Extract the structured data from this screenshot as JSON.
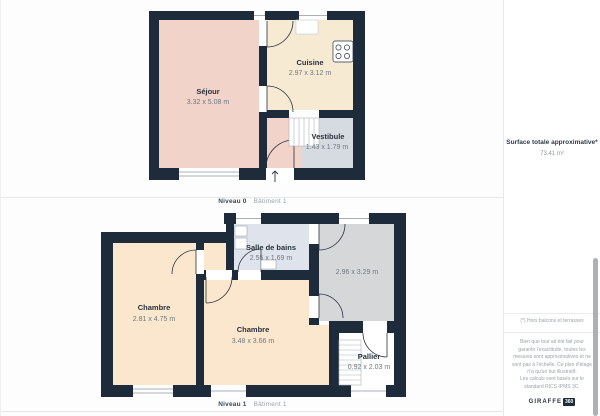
{
  "pages": [
    {
      "level": "Niveau 0",
      "building": "Bâtiment 1",
      "rooms": {
        "sejour": {
          "name": "Séjour",
          "dims": "3.32 x 5.08 m"
        },
        "cuisine": {
          "name": "Cuisine",
          "dims": "2.97 x 3.12 m"
        },
        "vestibule": {
          "name": "Vestibule",
          "dims": "1.43 x 1.79 m"
        }
      }
    },
    {
      "level": "Niveau 1",
      "building": "Bâtiment 1",
      "rooms": {
        "chambre_left": {
          "name": "Chambre",
          "dims": "2.81 x 4.75 m"
        },
        "chambre_middle": {
          "name": "Chambre",
          "dims": "3.48 x 3.66 m"
        },
        "salle_de_bains": {
          "name": "Salle de bains",
          "dims": "2.55 x 1.69 m"
        },
        "room_unnamed": {
          "dims": "2.96 x 3.29 m"
        },
        "pallier": {
          "name": "Pallier",
          "dims": "0.92 x 2.03 m"
        }
      }
    }
  ],
  "sidebar": {
    "surface_title": "Surface totale approximative*",
    "surface_value": "73.41 m²",
    "footnote": "(*) Hors balcons et terrasses",
    "disclaimer": "Bien que tout ait été fait pour garantir l'exactitude, toutes les mesures sont approximatives et ne sont pas à l'échelle. Ce plan d'étage n'a qu'un but illustratif.",
    "calc_note": "Les calculs sont basés sur le standard RICS IPMS 3C.",
    "brand_name": "GIRAFFE",
    "brand_suffix": "360"
  },
  "colors": {
    "wall": "#1d2b3b",
    "sejour_fill": "#f2d3c9",
    "cuisine_fill": "#f6ead3",
    "vestibule_fill": "#d6dbe1",
    "chambre_fill": "#fbe7cd",
    "bathroom_fill": "#dfe4ec",
    "unnamed_room_fill": "#d5d7d9",
    "pallier_fill": "#ffffff",
    "divider": "#e6e8ea",
    "scrollbar": "#adb1b6"
  }
}
